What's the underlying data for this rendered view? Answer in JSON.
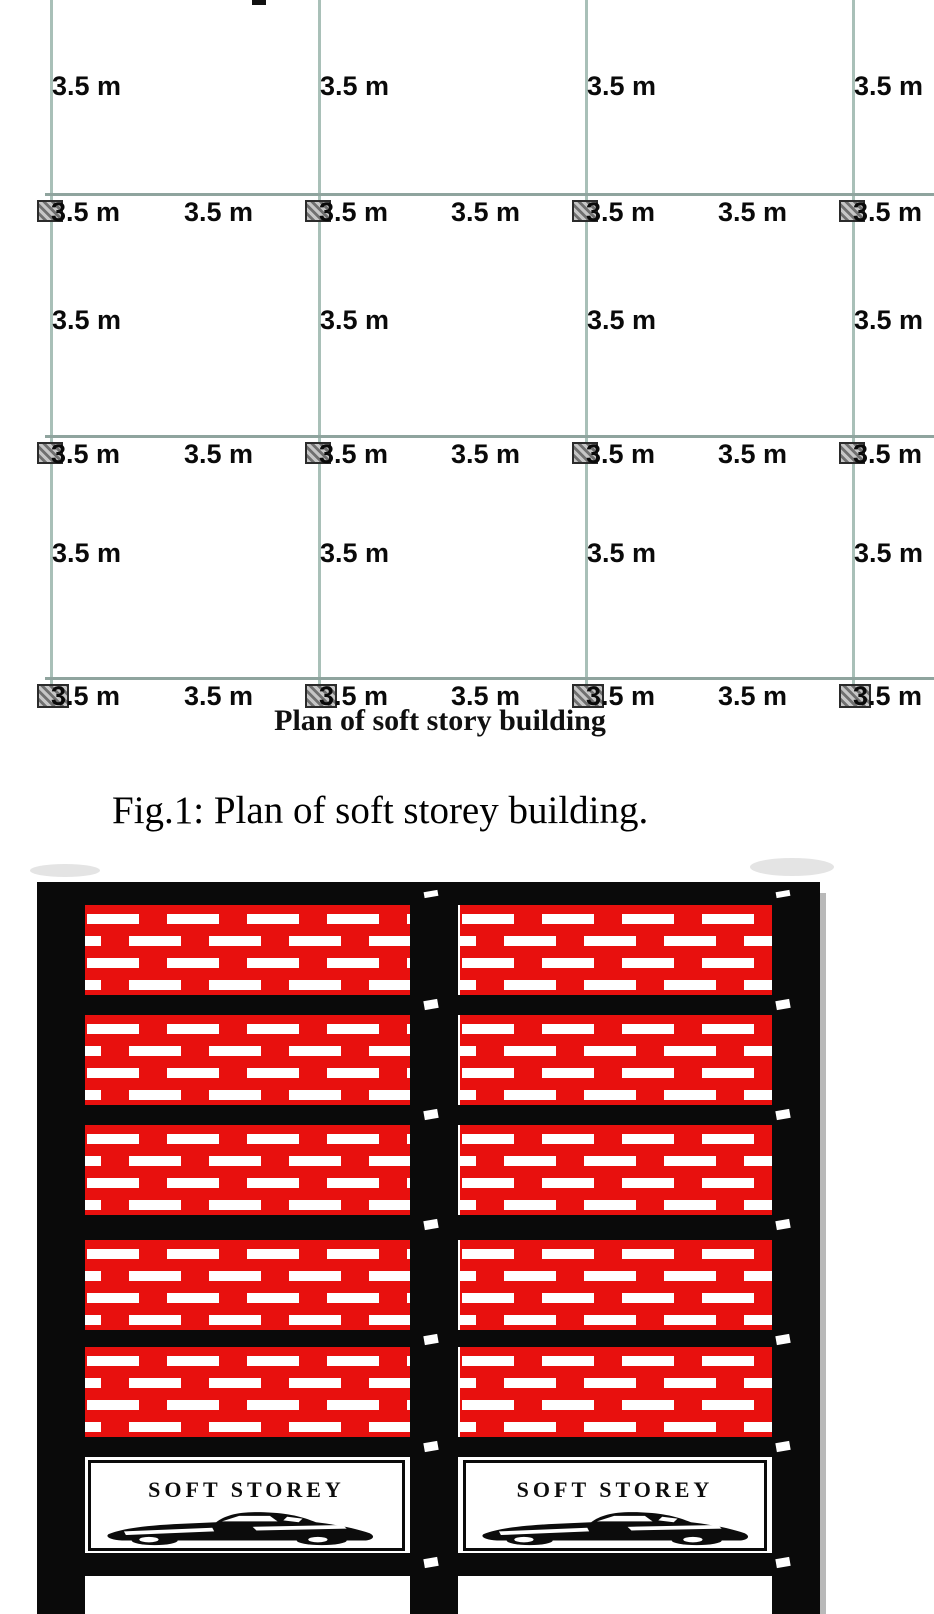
{
  "figure_caption": "Fig.1: Plan of soft storey building.",
  "plan": {
    "caption": "Plan of soft story building",
    "span_label": "3.5 m",
    "bay_span_m": 3.5,
    "grid": {
      "columns_x": [
        50,
        318,
        585,
        852
      ],
      "rows_y": [
        193,
        435,
        677
      ],
      "vline_top": 0,
      "vline_bottom": 688,
      "hline_left": 45,
      "hline_right": 934
    },
    "column_label_offsets_x": [
      51,
      319,
      586,
      853
    ],
    "midspan_labels_x": [
      184,
      451,
      718
    ],
    "vertical_label_rows_y": [
      74,
      308,
      541
    ],
    "marker": {
      "w": 26,
      "h": 22,
      "w_last": 32,
      "h_last": 24
    },
    "top_cut_mark": {
      "x": 252,
      "y": 0,
      "w": 14,
      "h": 5
    }
  },
  "elevation": {
    "label_soft_storey": "SOFT STOREY",
    "frame_color": "#0a0a0a",
    "brick_color": "#e8100e",
    "shadow_color": "#9b9b9b",
    "frame": {
      "top": 882,
      "bottom": 1614,
      "left": 37,
      "right": 820,
      "col_w": 48
    },
    "columns_left": [
      37,
      410,
      772
    ],
    "beams": [
      [
        882,
        905
      ],
      [
        995,
        1015
      ],
      [
        1105,
        1125
      ],
      [
        1215,
        1240
      ],
      [
        1330,
        1347
      ],
      [
        1437,
        1457
      ],
      [
        1553,
        1576
      ]
    ],
    "bays": [
      [
        85,
        410
      ],
      [
        460,
        772
      ]
    ],
    "storeys": [
      {
        "type": "brick",
        "top": 905,
        "bottom": 995
      },
      {
        "type": "brick",
        "top": 1015,
        "bottom": 1105
      },
      {
        "type": "brick",
        "top": 1125,
        "bottom": 1215
      },
      {
        "type": "brick",
        "top": 1240,
        "bottom": 1330
      },
      {
        "type": "brick",
        "top": 1347,
        "bottom": 1437
      },
      {
        "type": "soft",
        "top": 1457,
        "bottom": 1553
      },
      {
        "type": "open",
        "top": 1576,
        "bottom": 1614
      }
    ],
    "specks_x": [
      424,
      776
    ],
    "smudges": [
      {
        "x": 30,
        "y": 864,
        "w": 70,
        "h": 13
      },
      {
        "x": 750,
        "y": 858,
        "w": 84,
        "h": 18
      }
    ],
    "shadow_strip": {
      "x": 820,
      "y": 893,
      "w": 6,
      "h": 721
    }
  }
}
